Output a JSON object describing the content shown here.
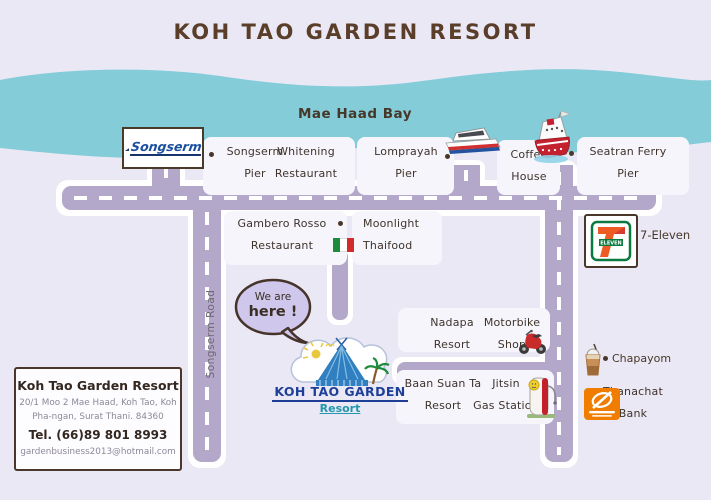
{
  "title": "KOH TAO GARDEN RESORT",
  "bay_label": "Mae Haad Bay",
  "roads": {
    "songserm_road": "Songserm Road"
  },
  "marker_bubble": {
    "line1": "We are",
    "line2": "here !"
  },
  "pois": {
    "songserm_pier": {
      "line1": "Songserm",
      "line2": "Pier"
    },
    "whitening": {
      "line1": "Whitening",
      "line2": "Restaurant"
    },
    "lomprayah": {
      "line1": "Lomprayah",
      "line2": "Pier"
    },
    "coffee_house": {
      "line1": "Coffee",
      "line2": "House"
    },
    "seatran": {
      "line1": "Seatran Ferry",
      "line2": "Pier"
    },
    "gambero": {
      "line1": "Gambero Rosso",
      "line2": "Restaurant"
    },
    "moonlight": {
      "line1": "Moonlight",
      "line2": "Thaifood"
    },
    "seven_eleven": {
      "label": "7-Eleven"
    },
    "nadapa": {
      "line1": "Nadapa",
      "line2": "Resort"
    },
    "motorbike": {
      "line1": "Motorbike",
      "line2": "Shop"
    },
    "baan_suan_ta": {
      "line1": "Baan Suan Ta",
      "line2": "Resort"
    },
    "jitsin": {
      "line1": "Jitsin",
      "line2": "Gas Station"
    },
    "chapayom": {
      "label": "Chapayom"
    },
    "thanachat": {
      "line1": "Thanachat",
      "line2": "Bank"
    }
  },
  "logos": {
    "songserm_text": "Songserm",
    "seven_eleven_seven": "7",
    "seven_eleven_eleven": "ELEVEN",
    "resort_name": "KOH TAO GARDEN",
    "resort_sub": "Resort"
  },
  "info_box": {
    "name": "Koh Tao Garden Resort",
    "address_line1": "20/1 Moo 2 Mae Haad, Koh Tao, Koh",
    "address_line2": "Pha-ngan, Surat Thani. 84360",
    "tel": "Tel. (66)89 801 8993",
    "email": "gardenbusiness2013@hotmail.com"
  },
  "colors": {
    "sea": "#84ccd8",
    "road": "#b3a8ca",
    "background": "#eae8f5",
    "title_brown": "#5a3e2a",
    "thanachat_orange": "#f07d00",
    "seatran_red": "#c42130",
    "italy_green": "#1d8a3c",
    "italy_red": "#d22b2b"
  }
}
